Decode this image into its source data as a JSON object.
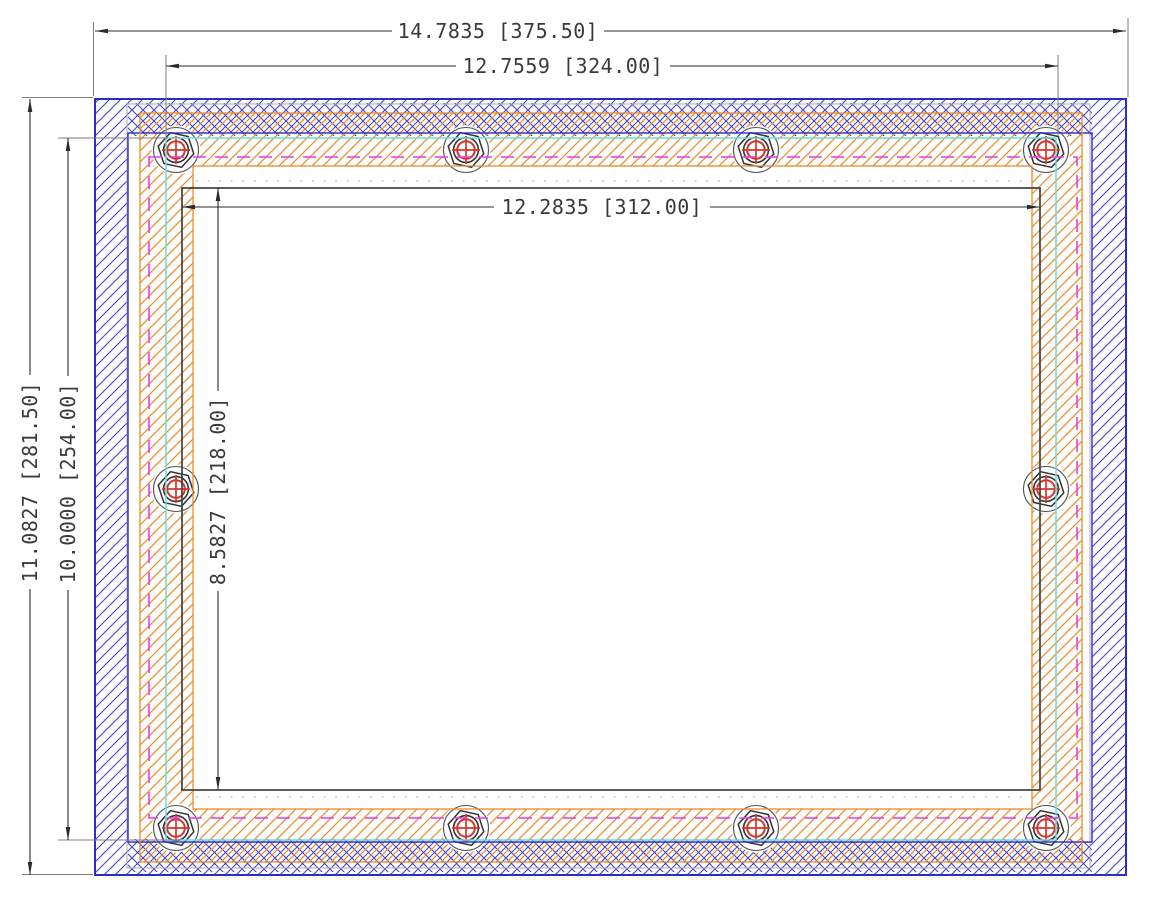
{
  "drawing": {
    "kind": "panel-mount-cad-drawing",
    "dims": {
      "d375": "14.7835 [375.50]",
      "d324": "12.7559 [324.00]",
      "d312": "12.2835 [312.00]",
      "d281": "11.0827 [281.50]",
      "d254": "10.0000 [254.00]",
      "d218": "8.5827 [218.00]"
    },
    "colors": {
      "frame_blue": "#2c2cc6",
      "hatch_blue": "#4343cf",
      "gasket_orange": "#e8892b",
      "lcd_cyan": "#6cdcdc",
      "pcb_magenta": "#e93ae9",
      "bolt_red": "#d8342a",
      "line_black": "#3f3f3f",
      "ext_gray": "#7e7e7e",
      "ghost_gray": "#ababab"
    },
    "fasteners": {
      "icon": "bolt-crosshair-icon",
      "count": 10,
      "positions": [
        [
          176,
          150
        ],
        [
          466,
          150
        ],
        [
          756,
          150
        ],
        [
          1046,
          150
        ],
        [
          176,
          489
        ],
        [
          1046,
          489
        ],
        [
          176,
          828
        ],
        [
          466,
          828
        ],
        [
          756,
          828
        ],
        [
          1046,
          828
        ]
      ]
    }
  }
}
